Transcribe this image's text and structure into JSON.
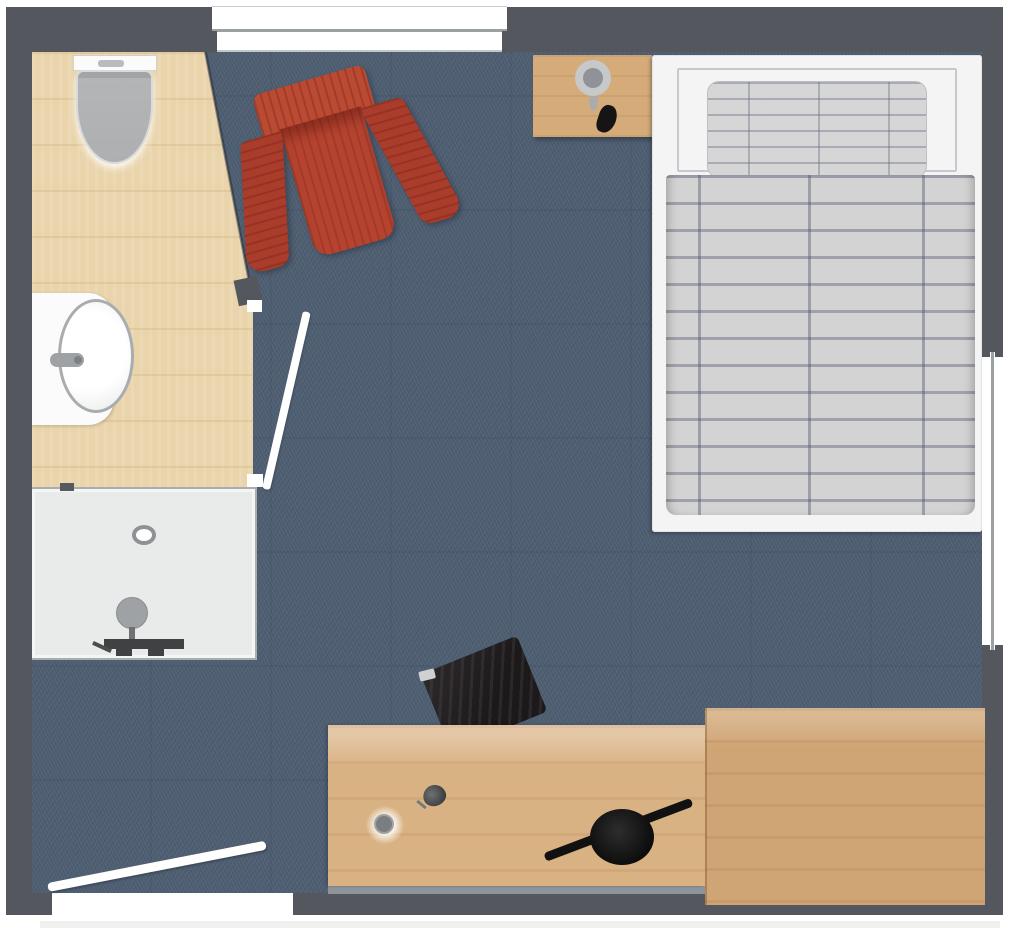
{
  "meta": {
    "title": "Room floor plan",
    "description": "Top-down architectural floor plan of a bedroom with en-suite bathroom, rendered with textured finishes and no text labels",
    "rooms": [
      "bedroom",
      "en-suite bathroom"
    ]
  },
  "colors": {
    "wall": "#54575e",
    "carpet": "#4e5e71",
    "bathroom_floor": "#e9d4ab",
    "shower": "#e9ebeb",
    "porcelain": "#fbfbfb",
    "fixture": "#9fa2a4",
    "bed_frame": "#f4f4f4",
    "bedding": "#d3d3d3",
    "bedding_stripe": "#50566e",
    "pillow": "#d6d6d6",
    "armchair": "#b5432f",
    "armchair_dark": "#a93c2a",
    "armchair_light": "#bb4a33",
    "nightstand": "#d5ab7a",
    "desk": "#d9b283",
    "sideboard": "#d0a575",
    "chair": "#1c191b",
    "tv": "#111111",
    "lamp": "#8f9296",
    "window": "#ffffff",
    "window_frame": "#9ba0a3",
    "shadow": "#8f949b",
    "door": "#ffffff"
  },
  "furniture": {
    "carpet": {
      "label": "Bedroom carpet floor"
    },
    "bathroom_floor": {
      "label": "Bathroom wooden floor"
    },
    "toilet": {
      "label": "Toilet"
    },
    "sink": {
      "label": "Washbasin with counter"
    },
    "faucet": {
      "label": "Faucet"
    },
    "shower": {
      "label": "Shower with drain and mixer"
    },
    "bathroom_door": {
      "label": "Bathroom door (open leaf)"
    },
    "entry_door": {
      "label": "Entrance door (open leaf)"
    },
    "armchair": {
      "label": "Red upholstered armchair"
    },
    "nightstand": {
      "label": "Bedside table"
    },
    "bedside_lamp": {
      "label": "Bedside lamp"
    },
    "bedside_object": {
      "label": "Dark decor object"
    },
    "bed": {
      "label": "Single bed"
    },
    "pillow": {
      "label": "Plaid pillow"
    },
    "duvet": {
      "label": "Plaid duvet"
    },
    "desk": {
      "label": "Desk"
    },
    "desk_chair": {
      "label": "Dark desk chair"
    },
    "desk_lamp": {
      "label": "Desk lamp"
    },
    "tv": {
      "label": "Television on stand"
    },
    "sideboard": {
      "label": "Sideboard / luggage bench"
    },
    "window_top": {
      "label": "Window in top wall"
    },
    "window_right": {
      "label": "Window in right wall"
    },
    "walls": {
      "label": "Exterior walls"
    }
  }
}
